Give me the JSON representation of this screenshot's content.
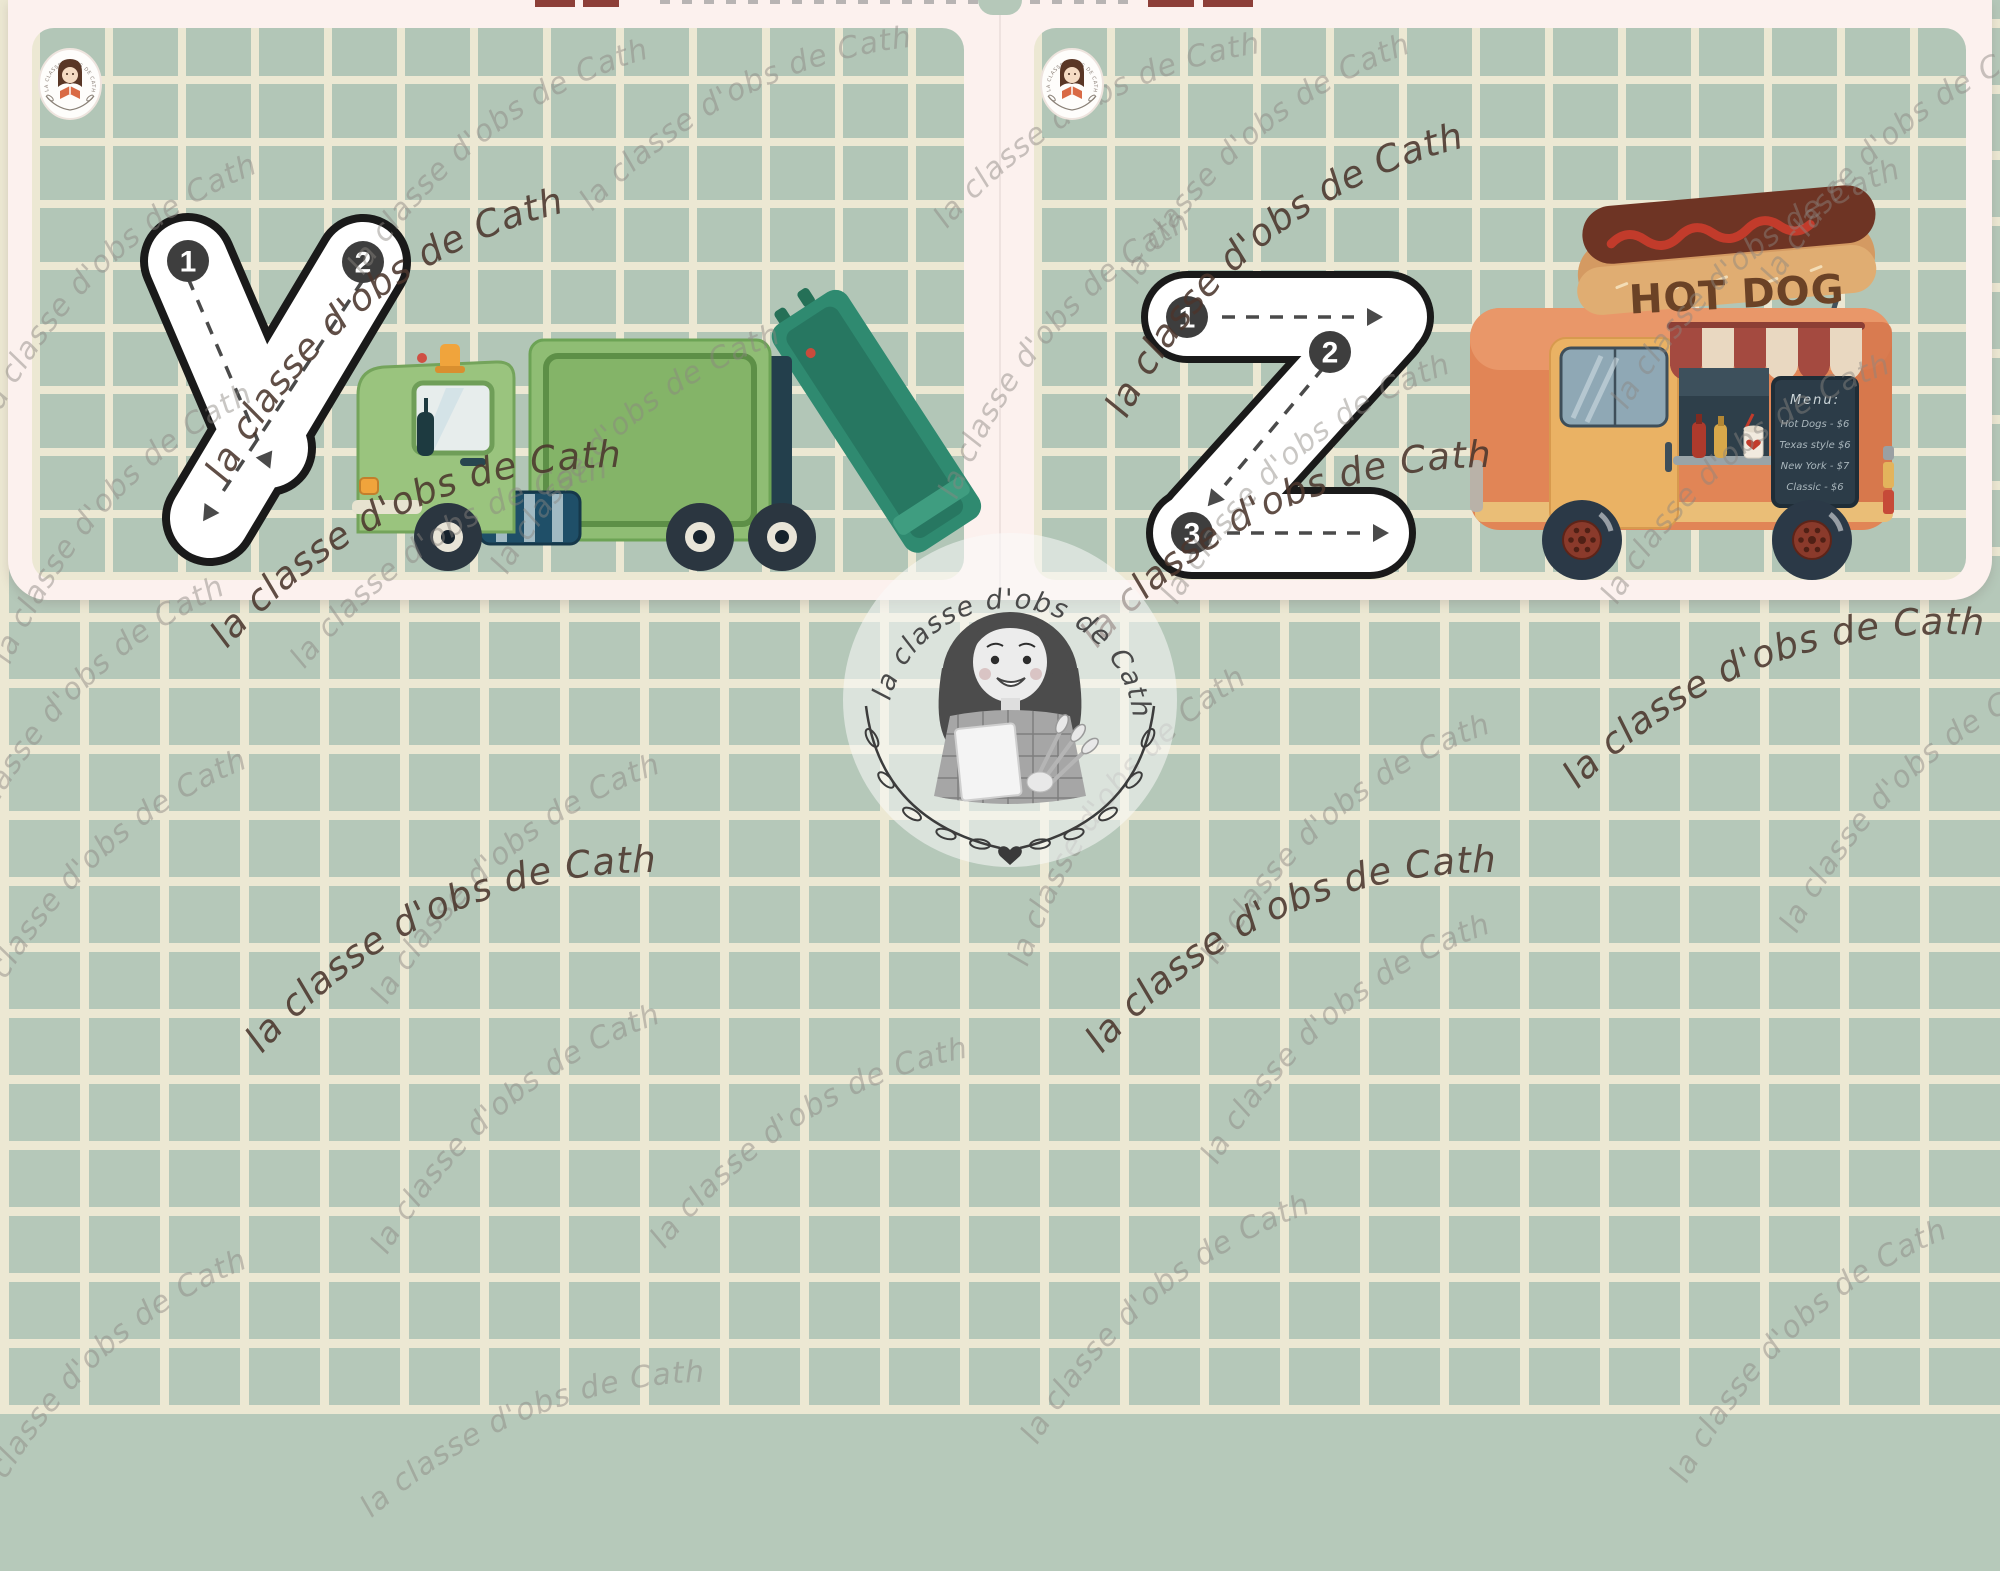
{
  "watermark": {
    "text": "la classe d'obs de Cath"
  },
  "logo": {
    "arc_text": "la classe d'obs de Cath"
  },
  "corner_badge": {
    "arc_text": "LA CLASSE D'OBS DE CATH"
  },
  "cards": [
    {
      "letter": "y",
      "illustration": "garbage-truck",
      "stroke_numbers": [
        "1",
        "2"
      ]
    },
    {
      "letter": "z",
      "illustration": "hot-dog-food-truck",
      "stroke_numbers": [
        "1",
        "2",
        "3"
      ]
    }
  ],
  "hotdog_truck": {
    "sign": "HOT DOG",
    "menu_title": "Menu:",
    "menu_items": [
      "Hot Dogs - $6",
      "Texas style $6",
      "New York - $7",
      "Classic - $6"
    ]
  },
  "colors": {
    "page_pink": "#fcf1ee",
    "grid_green": "#b5c8b9",
    "grid_line": "#ece8d3",
    "stroke_badge": "#3e3e3e",
    "watermark_gray": "#8b8681",
    "watermark_brown": "#4b362d",
    "truck_green": "#8fbd74",
    "loader_teal": "#2f8a70",
    "foodtruck_orange": "#e18556",
    "awning_red": "#a44a40"
  }
}
